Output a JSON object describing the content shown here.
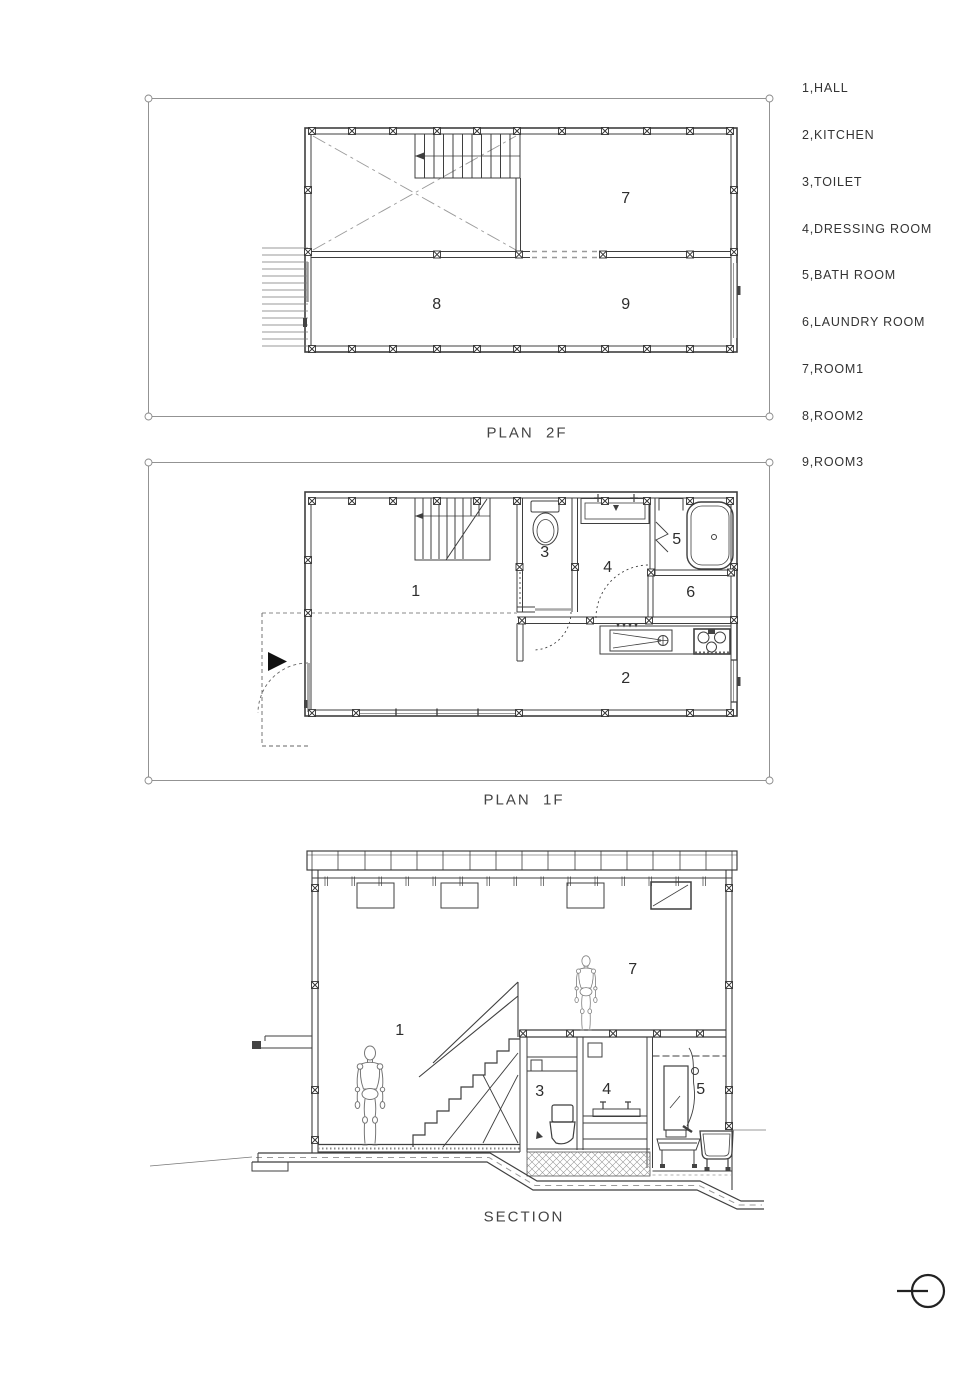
{
  "page": {
    "background": "#ffffff",
    "ink": "#3f3f3f",
    "light_line": "#999999"
  },
  "legend": {
    "items": [
      "1,HALL",
      "2,KITCHEN",
      "3,TOILET",
      "4,DRESSING ROOM",
      "5,BATH ROOM",
      "6,LAUNDRY ROOM",
      "7,ROOM1",
      "8,ROOM2",
      "9,ROOM3"
    ]
  },
  "plan2f": {
    "title": "PLAN  2F",
    "room_labels": [
      "7",
      "8",
      "9"
    ]
  },
  "plan1f": {
    "title": "PLAN  1F",
    "room_labels": [
      "1",
      "2",
      "3",
      "4",
      "5",
      "6"
    ]
  },
  "section": {
    "title": "SECTION",
    "room_labels": [
      "1",
      "7",
      "3",
      "4",
      "5"
    ]
  }
}
